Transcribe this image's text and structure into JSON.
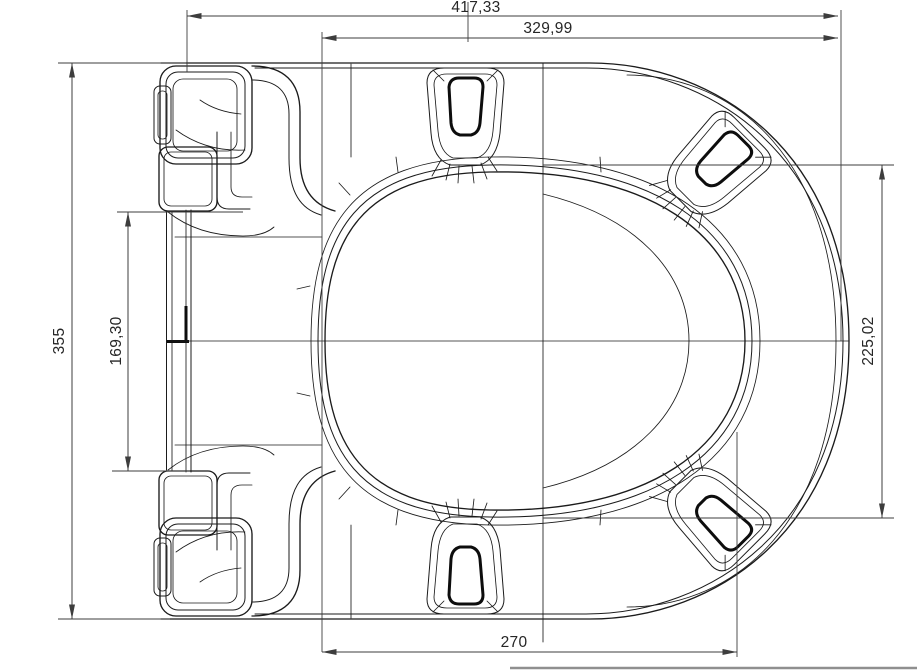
{
  "drawing": {
    "title": "toilet-seat-top-view-technical-drawing",
    "units_style": "comma-decimal",
    "colors": {
      "line": "#1b1b1b",
      "dimension": "#3d3d3d",
      "background": "#ffffff",
      "pad": "#0d0d0d"
    },
    "dimensions": {
      "width_overall": "417,33",
      "width_inner": "329,99",
      "height_overall": "355",
      "hinge_spacing": "169,30",
      "height_front": "225,02",
      "width_bottom": "270"
    }
  }
}
